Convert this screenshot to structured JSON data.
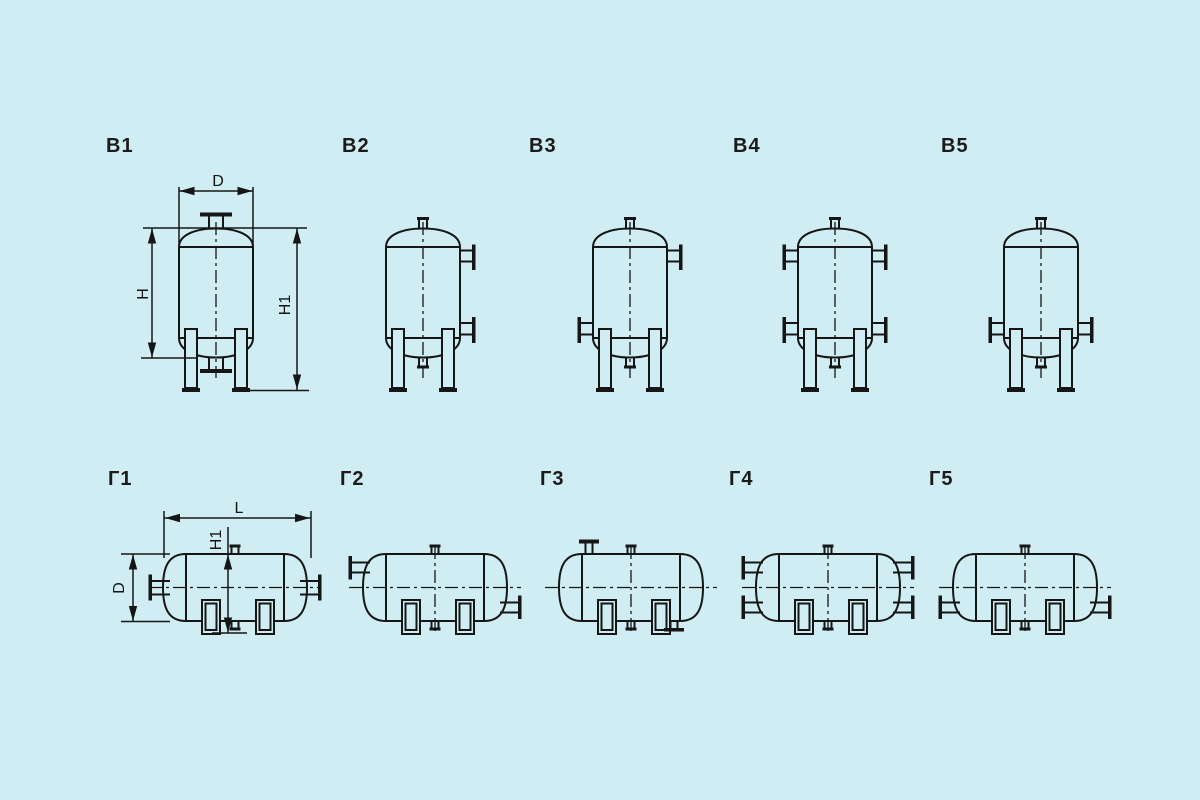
{
  "colors": {
    "background": "#cfedf2",
    "line": "#161616",
    "label": "#1b1b1b"
  },
  "dimension_labels": {
    "diameter": "D",
    "height": "H",
    "height_overall": "H1",
    "length": "L"
  },
  "variants_vertical": [
    {
      "code": "В1",
      "nozzles": [
        "top-flanged",
        "bottom-flanged"
      ],
      "dimensions": [
        "D",
        "H",
        "H1"
      ]
    },
    {
      "code": "В2",
      "nozzles": [
        "top-stub",
        "bottom-stub",
        "side-upper-right",
        "side-lower-right"
      ]
    },
    {
      "code": "В3",
      "nozzles": [
        "top-stub",
        "bottom-stub",
        "side-upper-right",
        "side-lower-left"
      ]
    },
    {
      "code": "В4",
      "nozzles": [
        "top-stub",
        "bottom-stub",
        "side-upper-left",
        "side-upper-right",
        "side-lower-left",
        "side-lower-right"
      ]
    },
    {
      "code": "В5",
      "nozzles": [
        "top-stub",
        "bottom-stub",
        "side-lower-left",
        "side-lower-right"
      ]
    }
  ],
  "variants_horizontal": [
    {
      "code": "Г1",
      "nozzles": [
        "end-center-left",
        "end-center-right",
        "top-stub",
        "bottom-stub"
      ],
      "dimensions": [
        "L",
        "H1",
        "D"
      ],
      "vertical_centerline": false
    },
    {
      "code": "Г2",
      "nozzles": [
        "end-upper-left",
        "end-lower-right",
        "top-stub",
        "bottom-stub"
      ],
      "vertical_centerline": true
    },
    {
      "code": "Г3",
      "nozzles": [
        "top-flanged-left",
        "top-stub",
        "bottom-stub",
        "bottom-drain-right"
      ],
      "vertical_centerline": true
    },
    {
      "code": "Г4",
      "nozzles": [
        "end-upper-left",
        "end-lower-left",
        "end-upper-right",
        "end-lower-right",
        "top-stub",
        "bottom-stub"
      ],
      "vertical_centerline": true
    },
    {
      "code": "Г5",
      "nozzles": [
        "end-lower-left",
        "end-lower-right",
        "top-stub",
        "bottom-stub"
      ],
      "vertical_centerline": true
    }
  ]
}
